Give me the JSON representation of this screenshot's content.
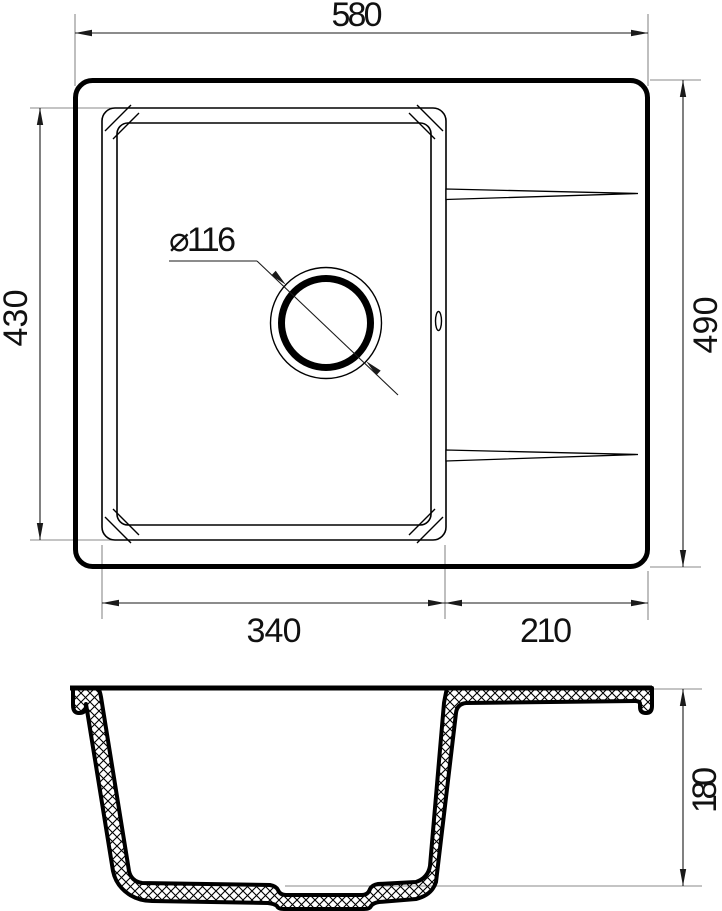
{
  "dimensions": {
    "overall_width": "580",
    "overall_depth": "490",
    "bowl_depth": "430",
    "bowl_width": "340",
    "drainboard_width": "210",
    "drain_diameter": "⌀116",
    "section_height": "180"
  },
  "colors": {
    "line": "#000000",
    "dim": "#1a1a1a",
    "extension": "#8a8a8a",
    "background": "#ffffff"
  }
}
